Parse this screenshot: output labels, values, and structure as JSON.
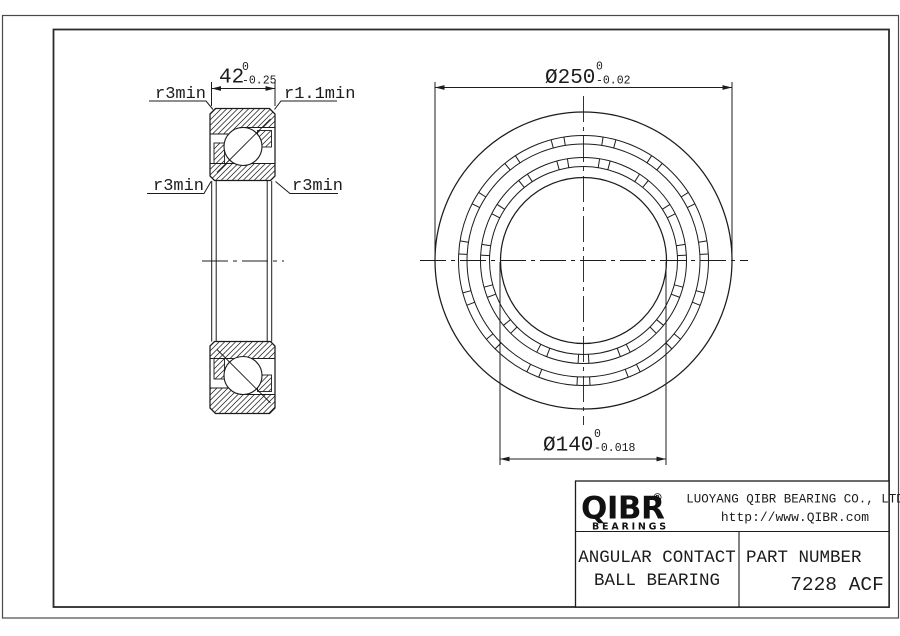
{
  "drawing": {
    "section_view": {
      "width_dim": {
        "value": "42",
        "tol_upper": "0",
        "tol_lower": "-0.25"
      },
      "labels": {
        "top_left": "r3min",
        "top_right": "r1.1min",
        "bottom_left": "r3min",
        "bottom_right": "r3min"
      }
    },
    "front_view": {
      "od_dim": {
        "value": "Ø250",
        "tol_upper": "0",
        "tol_lower": "-0.02"
      },
      "bore_dim": {
        "value": "Ø140",
        "tol_upper": "0",
        "tol_lower": "-0.018"
      }
    }
  },
  "title_block": {
    "logo": {
      "text": "QIBR",
      "registered": "®",
      "subtext": "BEARINGS"
    },
    "company": "LUOYANG QIBR BEARING CO., LTD",
    "website": "http://www.QIBR.com",
    "product": {
      "line1": "ANGULAR CONTACT",
      "line2": "BALL BEARING"
    },
    "part_number_label": "PART NUMBER",
    "part_number": "7228 ACF"
  },
  "colors": {
    "line": "#1c1c1c",
    "background": "#ffffff"
  }
}
